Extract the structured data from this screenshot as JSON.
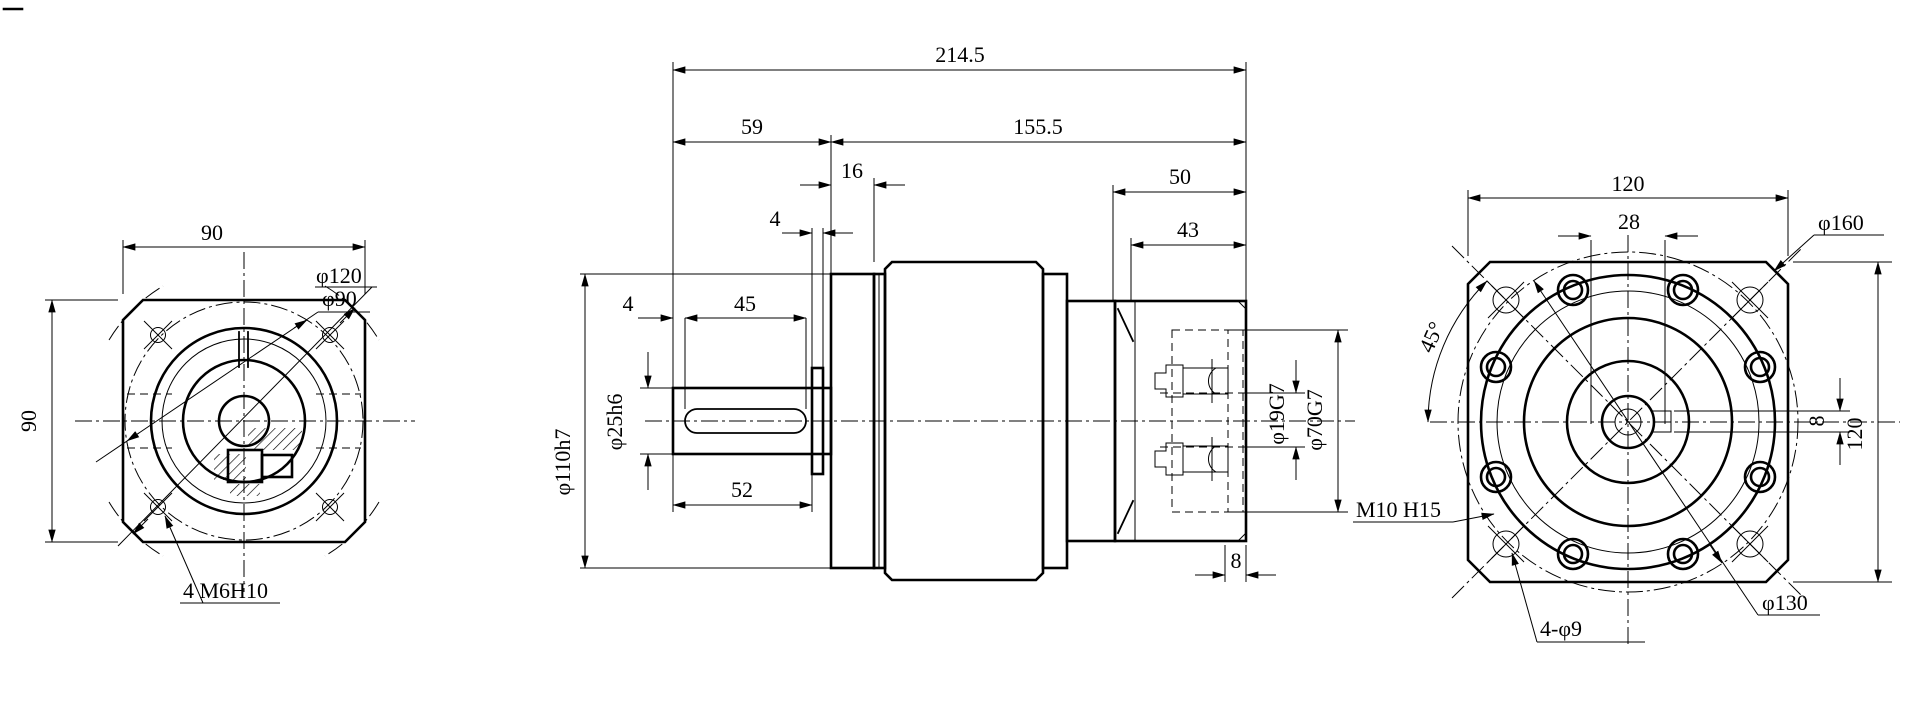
{
  "views": {
    "end_view_input": {
      "dim_width": "90",
      "dim_height": "90",
      "label_corner_circle": "φ120",
      "label_bolt_circle": "φ90",
      "label_tapped_holes": "4 M6H10"
    },
    "section_view": {
      "dim_overall_length": "214.5",
      "dim_shaft_length": "59",
      "dim_body_length": "155.5",
      "dim_front_flange": "16",
      "dim_collar": "4",
      "dim_key_offset": "4",
      "dim_key_length": "45",
      "dim_shaft_step": "52",
      "dim_pilot_dia": "φ110h7",
      "dim_shaft_dia": "φ25h6",
      "dim_adapter_length": "50",
      "dim_adapter_depth": "43",
      "dim_input_bore": "φ19G7",
      "dim_recess_dia": "φ70G7",
      "dim_lip": "8"
    },
    "end_view_output": {
      "dim_width": "120",
      "dim_center_spacing": "28",
      "label_corner_circle": "φ160",
      "dim_angle": "45°",
      "dim_keyway_width": "8",
      "dim_height": "120",
      "label_tapped_holes": "M10 H15",
      "label_bolt_circle": "φ130",
      "label_through_holes": "4-φ9"
    }
  }
}
